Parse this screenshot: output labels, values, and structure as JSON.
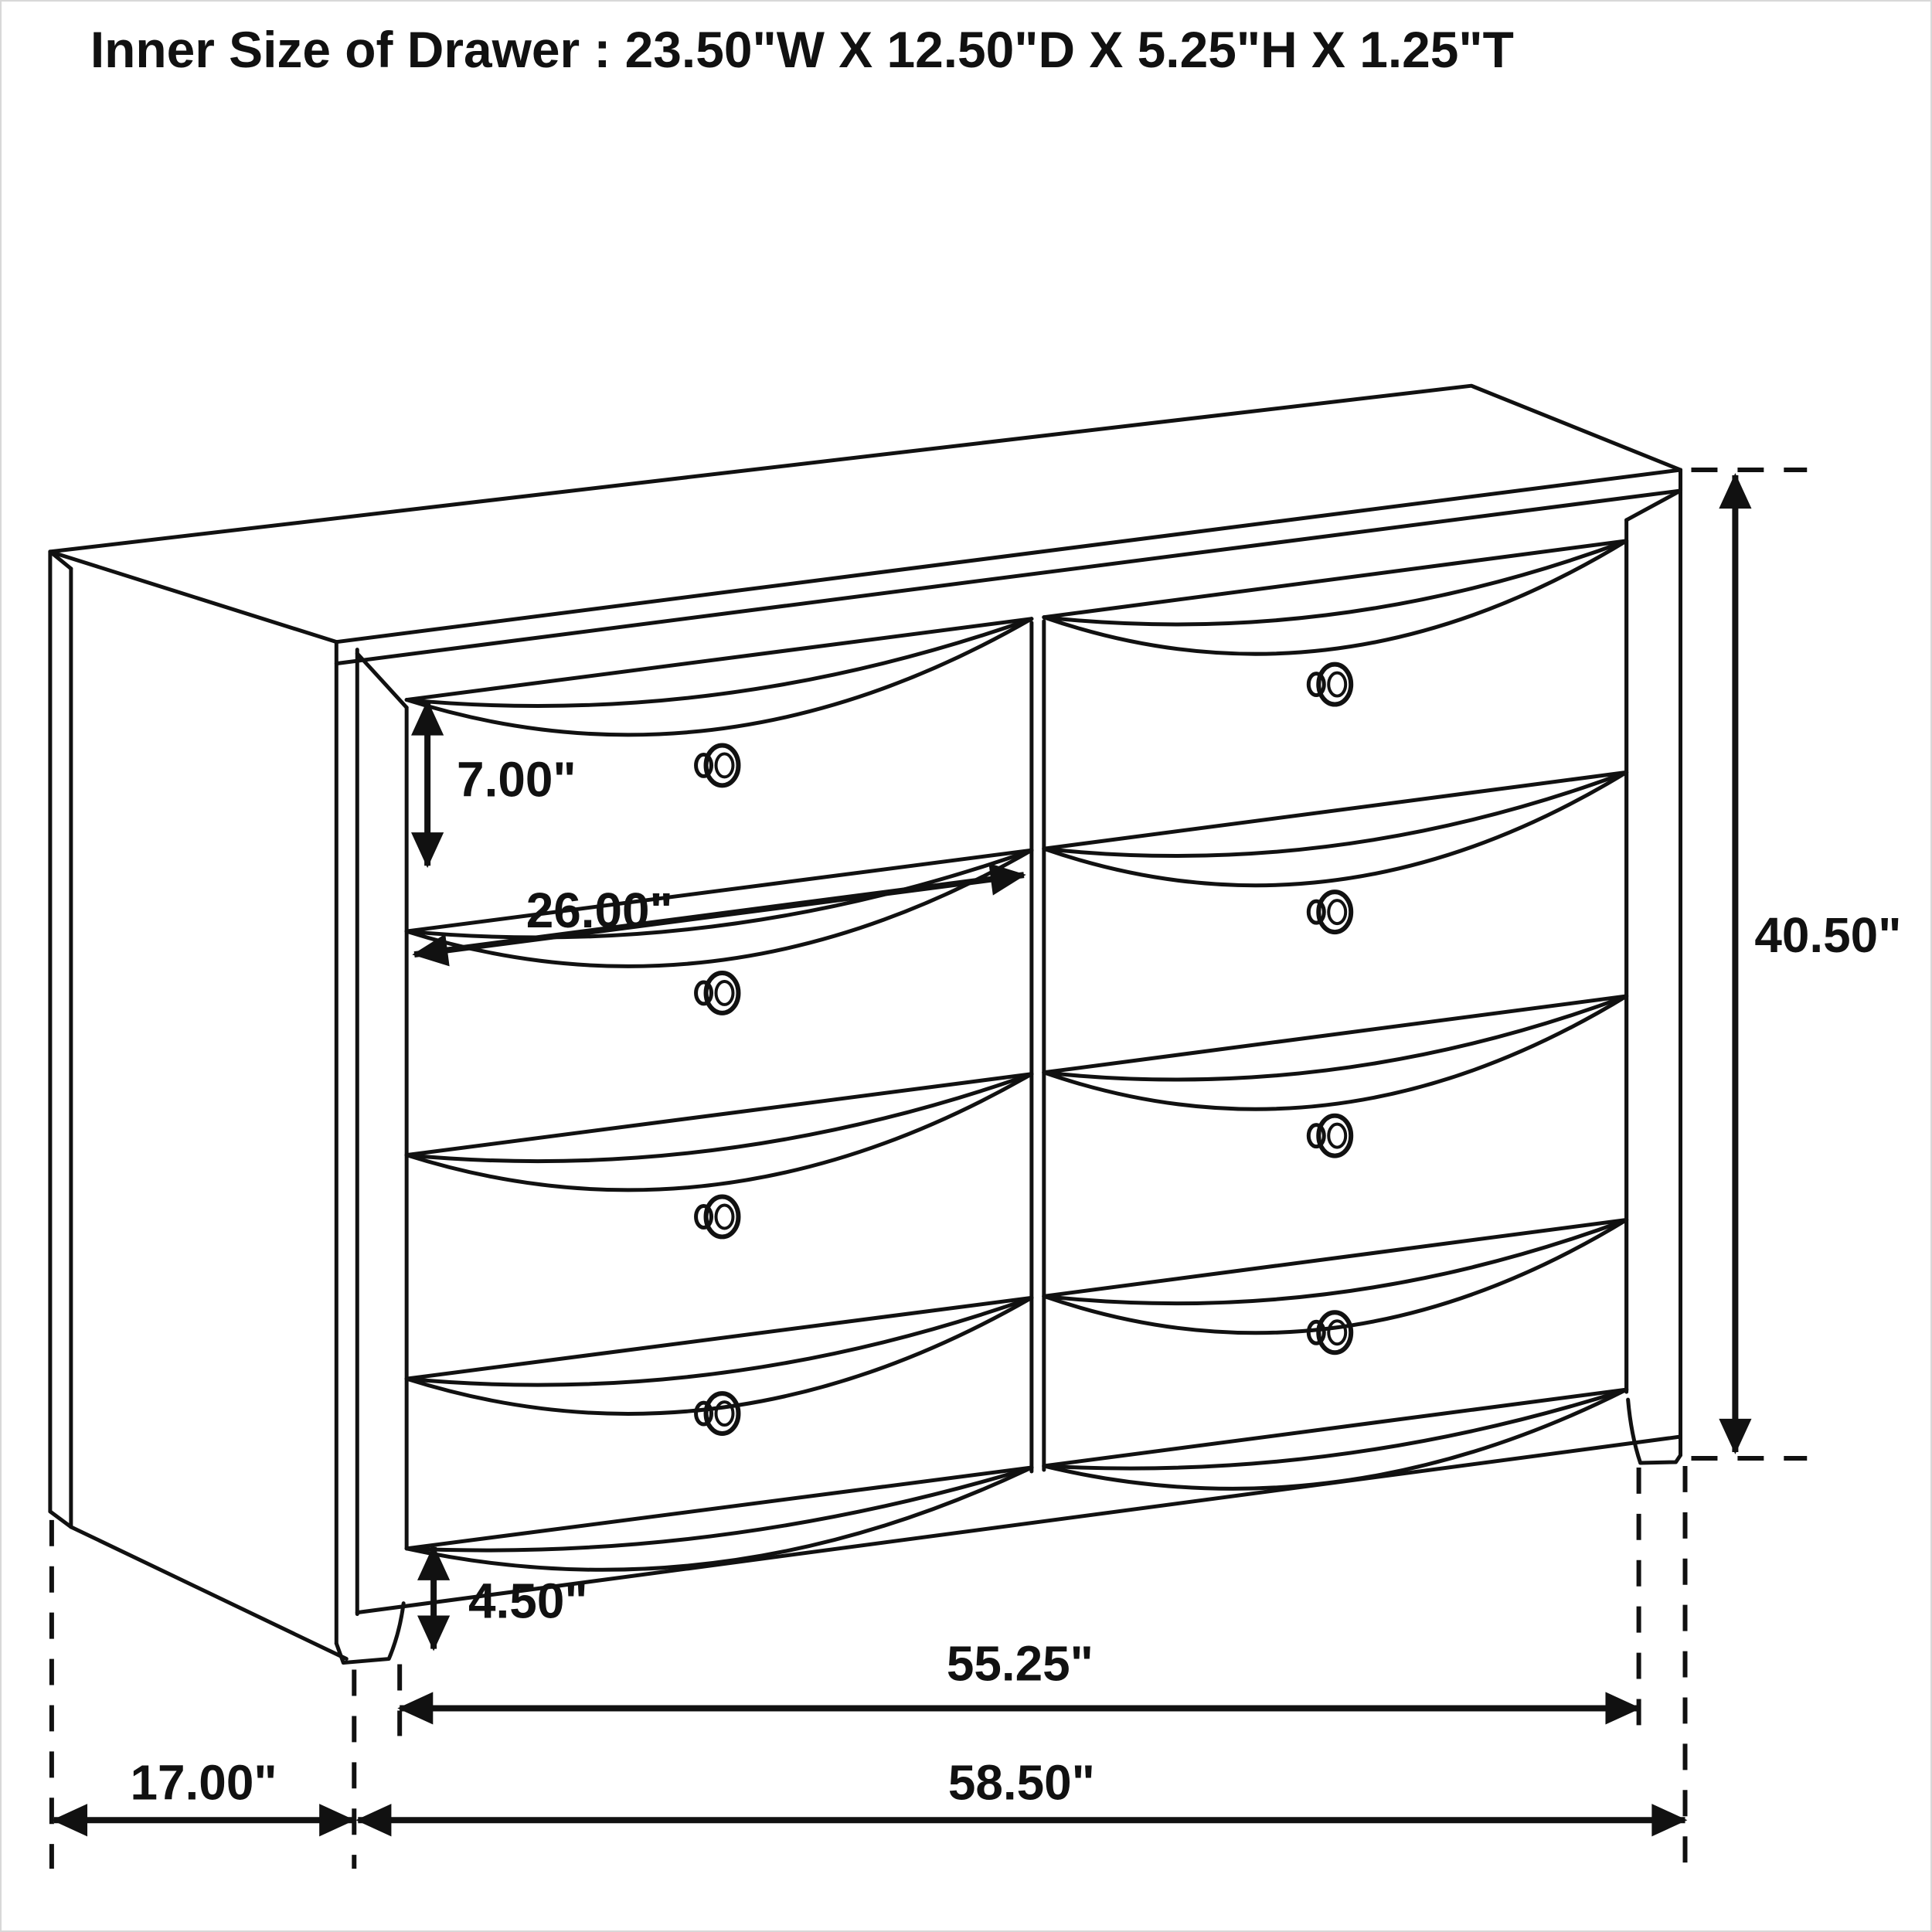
{
  "title": "Inner Size of Drawer : 23.50\"W X 12.50\"D X 5.25\"H X 1.25\"T",
  "diagram": {
    "type": "furniture-dimension-line-drawing",
    "object": "six-over-six dresser, 8 drawer fronts in 2 columns x 4 rows, perspective view",
    "style": "black line art on white background",
    "line_color": "#111111",
    "background_color": "#ffffff",
    "drawer_columns": 2,
    "drawer_rows": 4,
    "knob_count": 8,
    "dimensions": {
      "drawer_front_height": {
        "label": "7.00\"",
        "orientation": "vertical",
        "measures": "top drawer front height"
      },
      "drawer_front_width": {
        "label": "26.00\"",
        "orientation": "diagonal",
        "measures": "drawer front width to center divider"
      },
      "total_height": {
        "label": "40.50\"",
        "orientation": "vertical",
        "measures": "overall dresser height"
      },
      "leg_height": {
        "label": "4.50\"",
        "orientation": "vertical",
        "measures": "leg / apron height"
      },
      "width_between_legs": {
        "label": "55.25\"",
        "orientation": "horizontal",
        "measures": "width between front legs"
      },
      "side_depth": {
        "label": "17.00\"",
        "orientation": "horizontal",
        "measures": "side depth"
      },
      "total_width": {
        "label": "58.50\"",
        "orientation": "horizontal",
        "measures": "overall width"
      }
    }
  }
}
